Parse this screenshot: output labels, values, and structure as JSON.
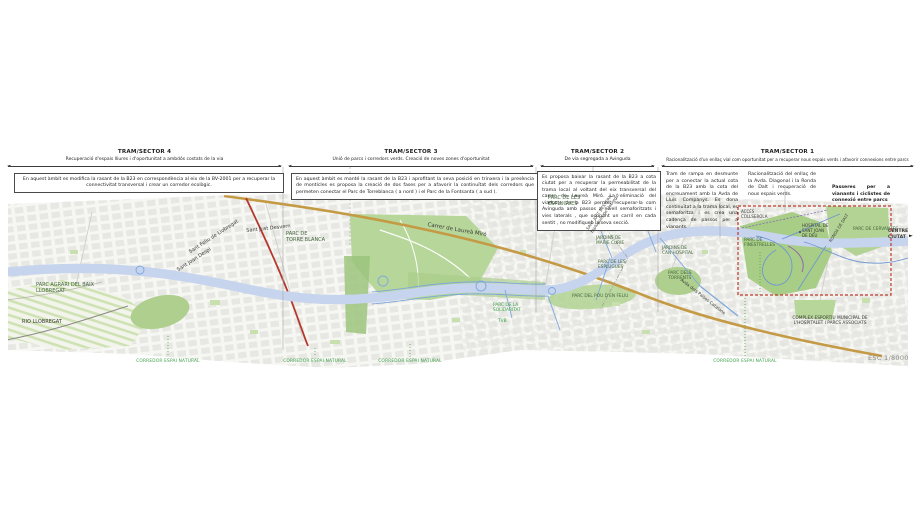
{
  "document": {
    "scale_label": "ESC 1/8000",
    "corridor_label": "CORREDOR ESPAI NATURAL"
  },
  "sectors": [
    {
      "title": "TRAM/SECTOR 4",
      "subtitle": "Recuperació d'espais lliures i d'oportunitat a ambdós costats de la via",
      "body": "En aquest àmbit es modifica la rasant de la B23 en correspondència al eix de la BV-2001 per a recuperar la connectivitat transversal i crear un corredor ecològic."
    },
    {
      "title": "TRAM/SECTOR 3",
      "subtitle": "Unió de parcs i corredors verds. Creació de noves zones d'oportunitat",
      "body": "En aquest àmbit es manté la rasant de la B23 i aprofitant la seva posició en trinxera i la presència de montícles es proposa la creació de dos fases per a afavorir la continuïtat dels corredors que permeten conectar el Parc de Torreblanca ( a nord ) i el Parc de la Fontsanta ( a sud )."
    },
    {
      "title": "TRAM/SECTOR 2",
      "subtitle": "De via segregada a Avinguda",
      "body": "Es proposa baixar la rasant de la B23 a cota ciutat per a recuperar la permeabilitat de la trama local al voltant del eix transversal del carrer de Laureà Miró. La eliminació del viaducte de la B23 permet recuperar-la com Avinguda amb passos a nivell semaforitzats i vies laterals , que ocupant un carril en cada sentit , no modifiquen la seva secció."
    },
    {
      "title": "TRAM/SECTOR 1",
      "subtitle": "Racionalització d'un enllaç vial com oportunitat per a recuperar nous espais verds i afavorir connexions entre parcs",
      "notes": [
        "Tram de rampa en desmunte per a conectar la actual cota de la B23 amb la cota del encreuament amb la Avda de Lluís Companys. Es dona continuïtat a la trama local, es semaforitza i es crea una cadença de passos per a vianants.",
        "Racionalització del enllaç de la Avda. Diagonal i la Ronda de Dalt i recuperació de nous espais verds.",
        "Passeres per a vianants i ciclistes de connexió entre parcs"
      ]
    }
  ],
  "map": {
    "labels": {
      "parc_agrari": "PARC AGRARI DEL BAIX\nLLOBREGAT",
      "rio_llobregat": "RIO LLOBREGAT",
      "sant_feliu": "Sant Feliu de Llobregat",
      "sant_joan_despi": "Sant Joan Despí",
      "sant_just": "Sant Just Desvern",
      "torre_blanca": "PARC DE\nTORRE BLANCA",
      "laurea_miro": "Carrer de Laureà Miró",
      "esplugues_top": "PARC DE LES\nESPLUGUES",
      "boundary": "SANT JUST DESVERN\nEsplugues de Llobregat",
      "marie_curie": "JARDINS DE\nMARIE CURIE",
      "esplugues_mid": "PARC DE LES\nESPLUGUES",
      "can_hospital": "JARDINS DE\nCAN HOSPITAL",
      "torrents": "PARC DELS\nTORRENTS",
      "pou_felix": "PARC DEL POU D'EN FELIU",
      "solidaritat": "PARC DE LA\nSOLIDARITAT",
      "tvb": "TVB",
      "paisos_catalans": "Avda dels Països Catalans",
      "acces_collserola": "ACCÉS\nCOLLSEROLA",
      "finestrelles": "PARC DE\nFINESTRELLES",
      "hospital": "HOSPITAL DE\nSANT JOAN\nDE DÉU",
      "ronda_dalt": "RONDA DE DALT",
      "cervantes": "PARC DE CERVANTES",
      "centre_ciutat": "CENTRE\nCIUTAT",
      "complex_esportiu": "COMPLEX ESPORTIU MUNICIPAL DE\nL'HOSPITALET I PARCS ASSOCIATS"
    },
    "colors": {
      "road_tan": "#c49a45",
      "road_red": "#b5382e",
      "corridor_blue": "#3f63b5",
      "park_green": "#b7d69a",
      "focus_box_red": "#c0392b",
      "corridor_label_green": "#3da048"
    }
  }
}
